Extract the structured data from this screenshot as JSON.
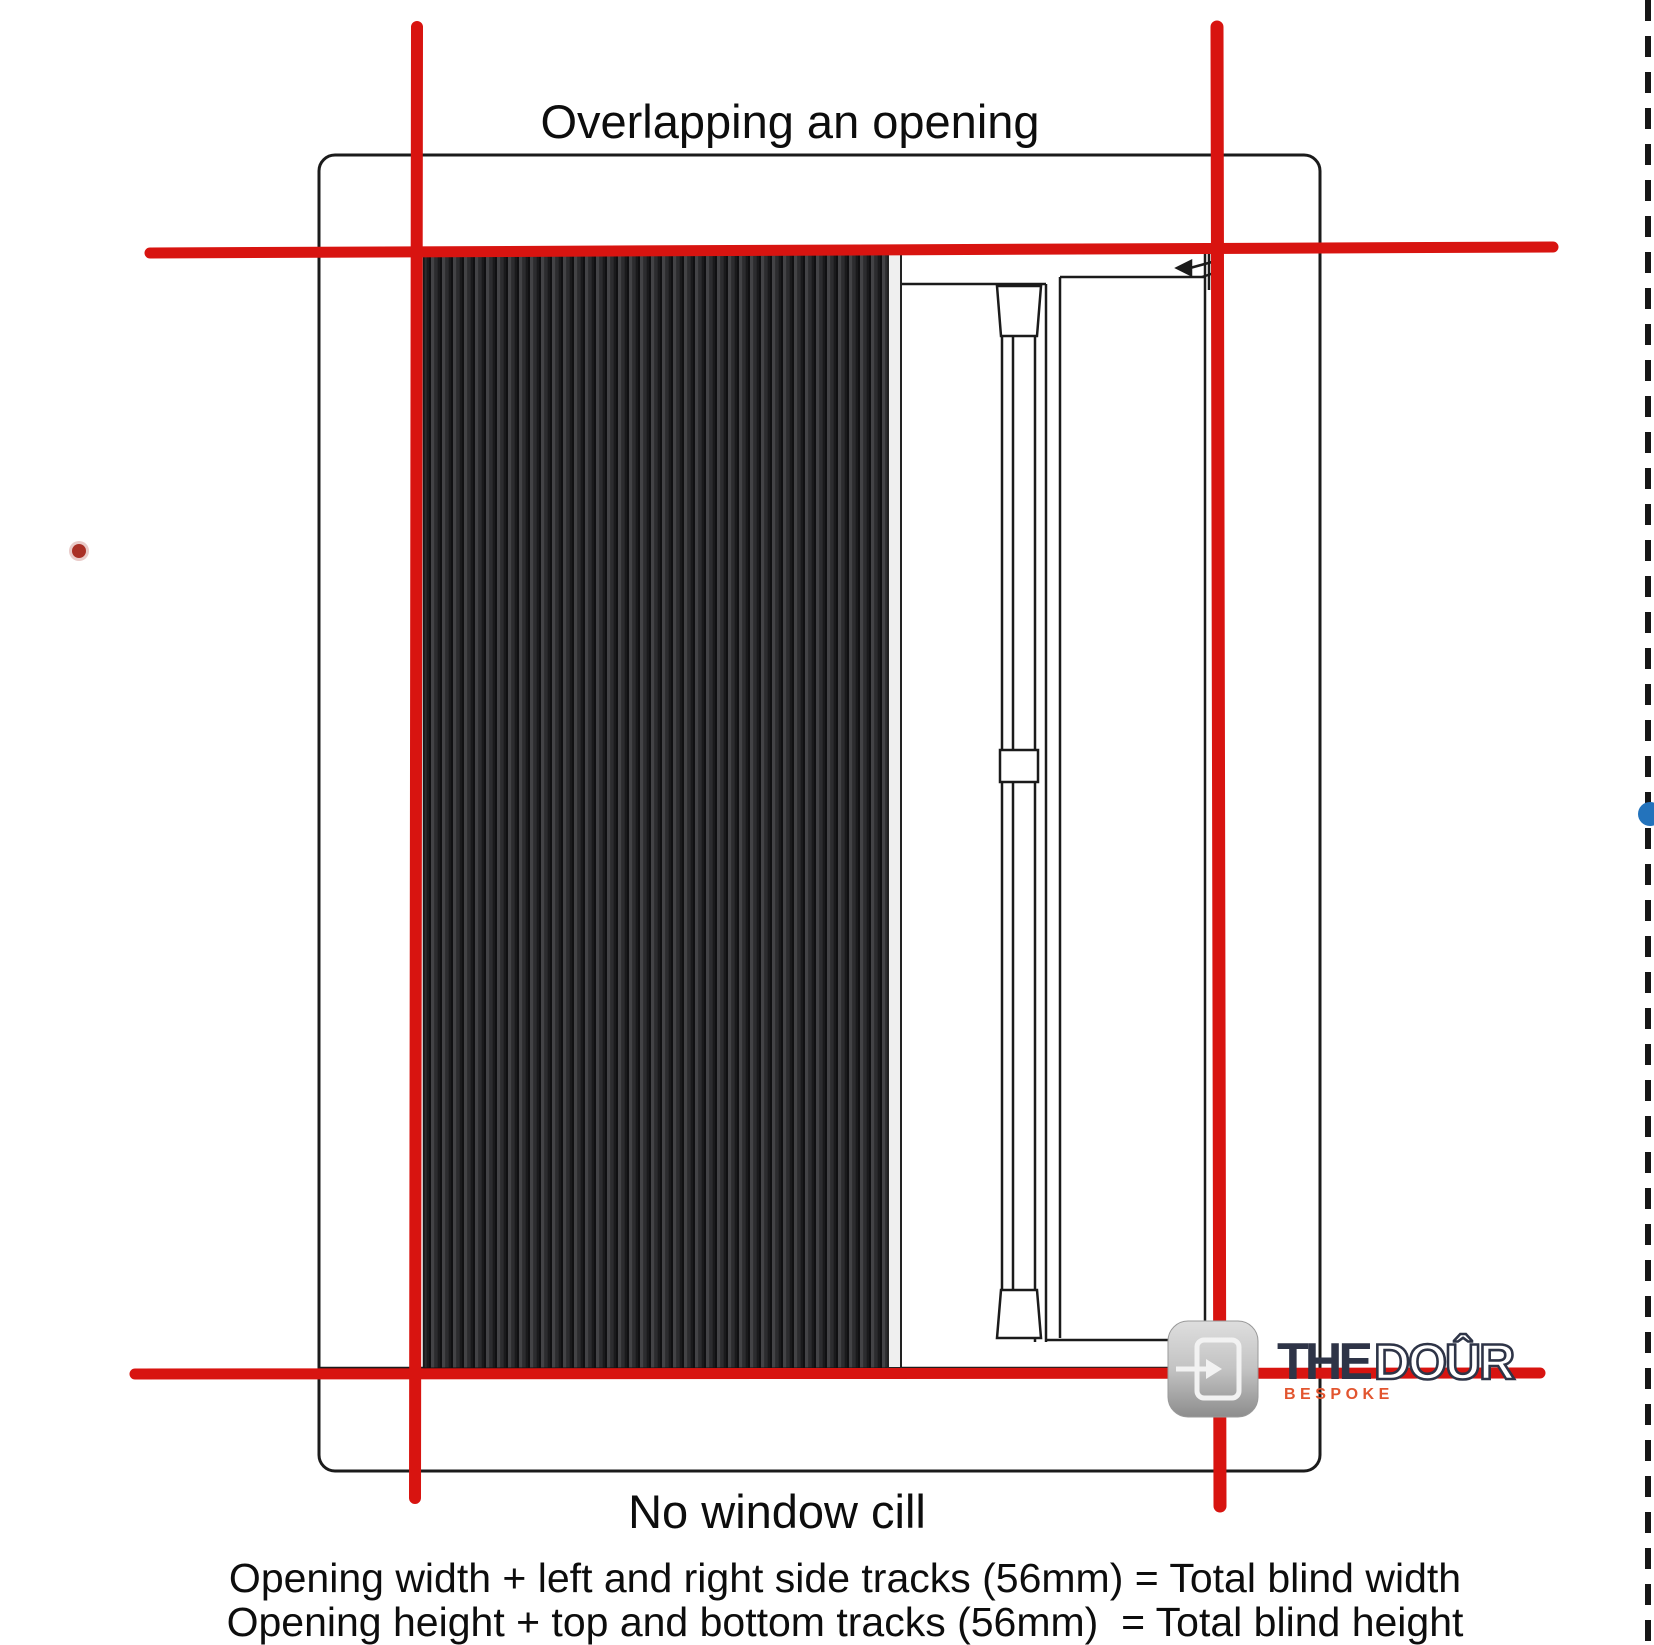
{
  "title": "Overlapping an opening",
  "diagram": {
    "caption": "No window cill",
    "formula_width": "Opening width + left and right side tracks (56mm) = Total blind width",
    "formula_height": "Opening height + top and bottom tracks (56mm)  = Total blind height",
    "track_allowance_mm": 56
  },
  "logo": {
    "the": "THE",
    "door": "DOÛR",
    "bespoke": "BESPOKE"
  },
  "colors": {
    "measure_line_red": "#d81410",
    "frame_stroke": "#1b1b1b",
    "blind_base": "#39393c",
    "logo_navy": "#2e3447",
    "logo_orange": "#e2552f",
    "marker_blue": "#2373bc",
    "marker_red": "#a93026",
    "border_dash": "#161616"
  }
}
